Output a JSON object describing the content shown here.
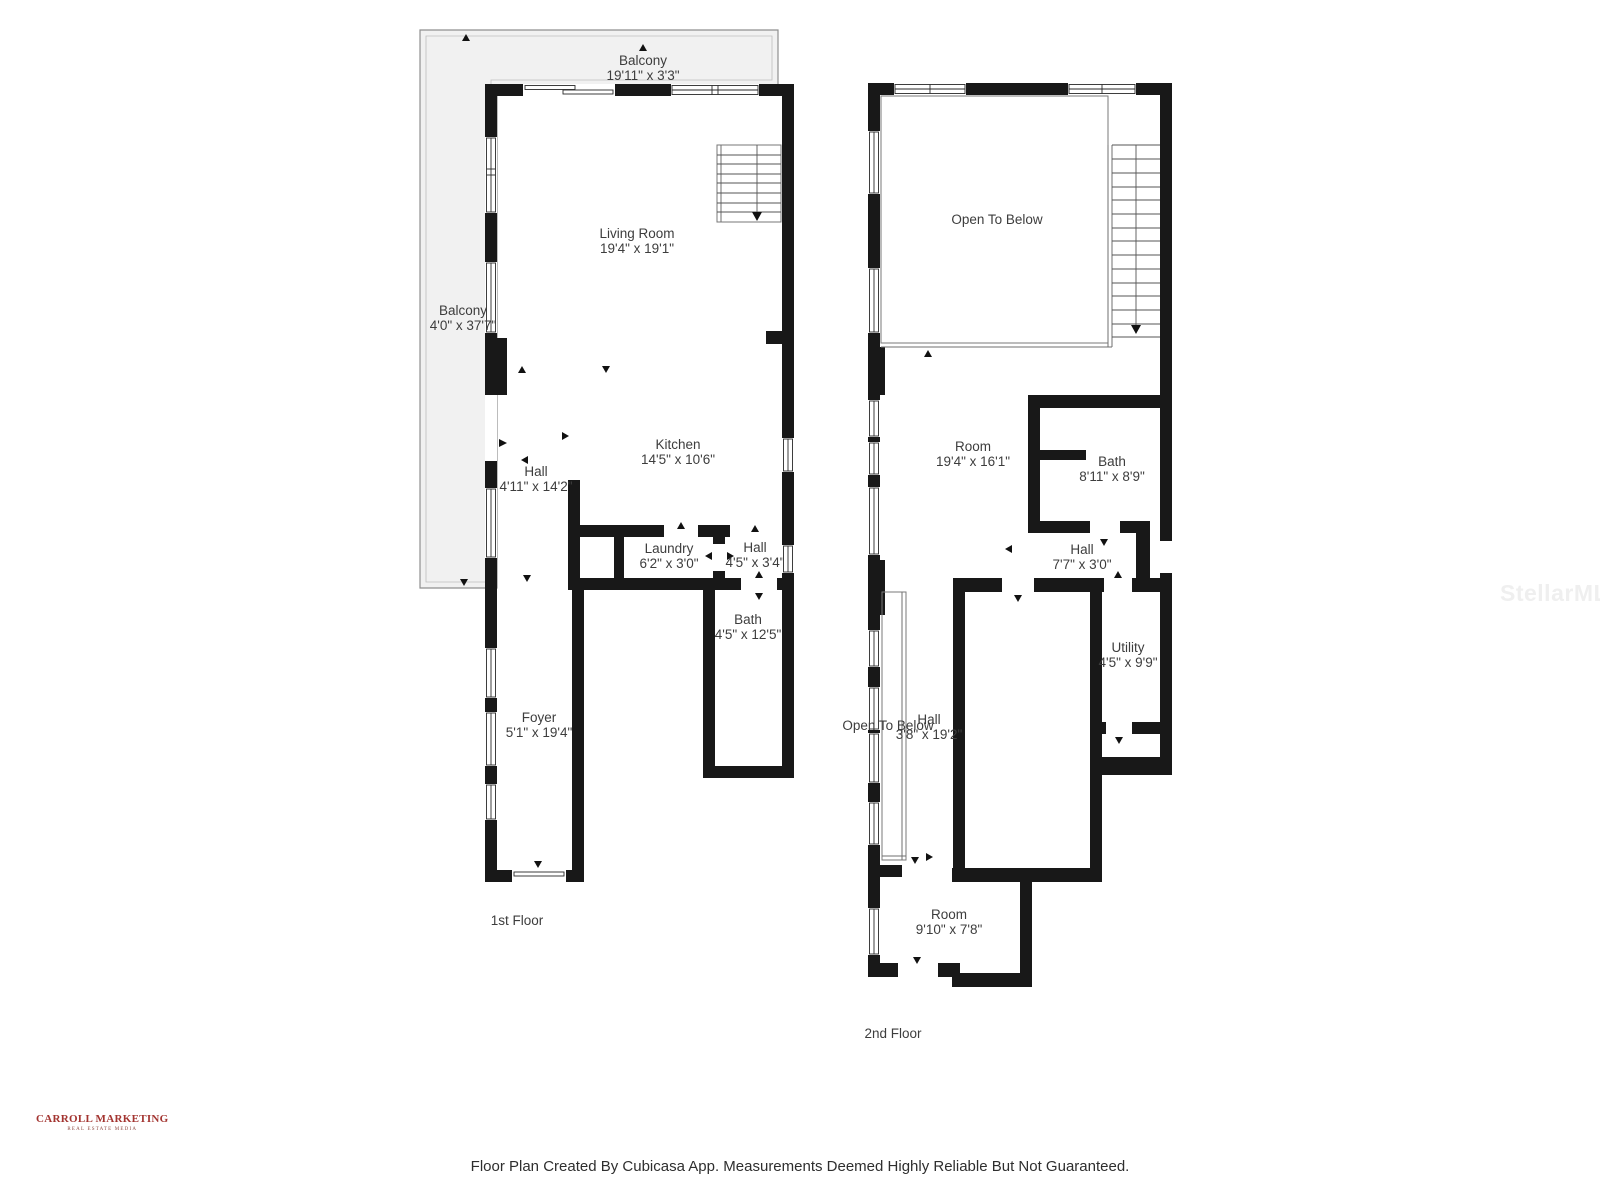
{
  "colors": {
    "wall": "#181818",
    "balcony_fill": "#f1f1f1",
    "brand_red": "#a33430",
    "label_text": "#3d3d3d",
    "watermark_gray": "#efefef"
  },
  "floor1": {
    "title": "1st Floor",
    "balcony_top": {
      "name": "Balcony",
      "dims": "19'11\" x 3'3\""
    },
    "balcony_left": {
      "name": "Balcony",
      "dims": "4'0\" x 37'7\""
    },
    "living_room": {
      "name": "Living Room",
      "dims": "19'4\" x 19'1\""
    },
    "kitchen": {
      "name": "Kitchen",
      "dims": "14'5\" x 10'6\""
    },
    "hall_upper": {
      "name": "Hall",
      "dims": "4'11\" x 14'2\""
    },
    "laundry": {
      "name": "Laundry",
      "dims": "6'2\" x 3'0\""
    },
    "hall_small": {
      "name": "Hall",
      "dims": "4'5\" x 3'4\""
    },
    "bath": {
      "name": "Bath",
      "dims": "4'5\" x 12'5\""
    },
    "foyer": {
      "name": "Foyer",
      "dims": "5'1\" x 19'4\""
    }
  },
  "floor2": {
    "title": "2nd Floor",
    "open_to_below_top": "Open To Below",
    "room_large": {
      "name": "Room",
      "dims": "19'4\" x 16'1\""
    },
    "bath": {
      "name": "Bath",
      "dims": "8'11\" x 8'9\""
    },
    "hall_upper": {
      "name": "Hall",
      "dims": "7'7\" x 3'0\""
    },
    "utility": {
      "name": "Utility",
      "dims": "4'5\" x 9'9\""
    },
    "open_to_below_hall": "Open To Below",
    "hall_long": {
      "name": "Hall",
      "dims": "3'8\" x 19'2\""
    },
    "room_small": {
      "name": "Room",
      "dims": "9'10\" x 7'8\""
    }
  },
  "watermark": "StellarMLS",
  "branding": {
    "company": "CARROLL MARKETING",
    "tagline": "REAL ESTATE MEDIA"
  },
  "footer": "Floor Plan Created By Cubicasa App. Measurements Deemed Highly Reliable But Not Guaranteed."
}
